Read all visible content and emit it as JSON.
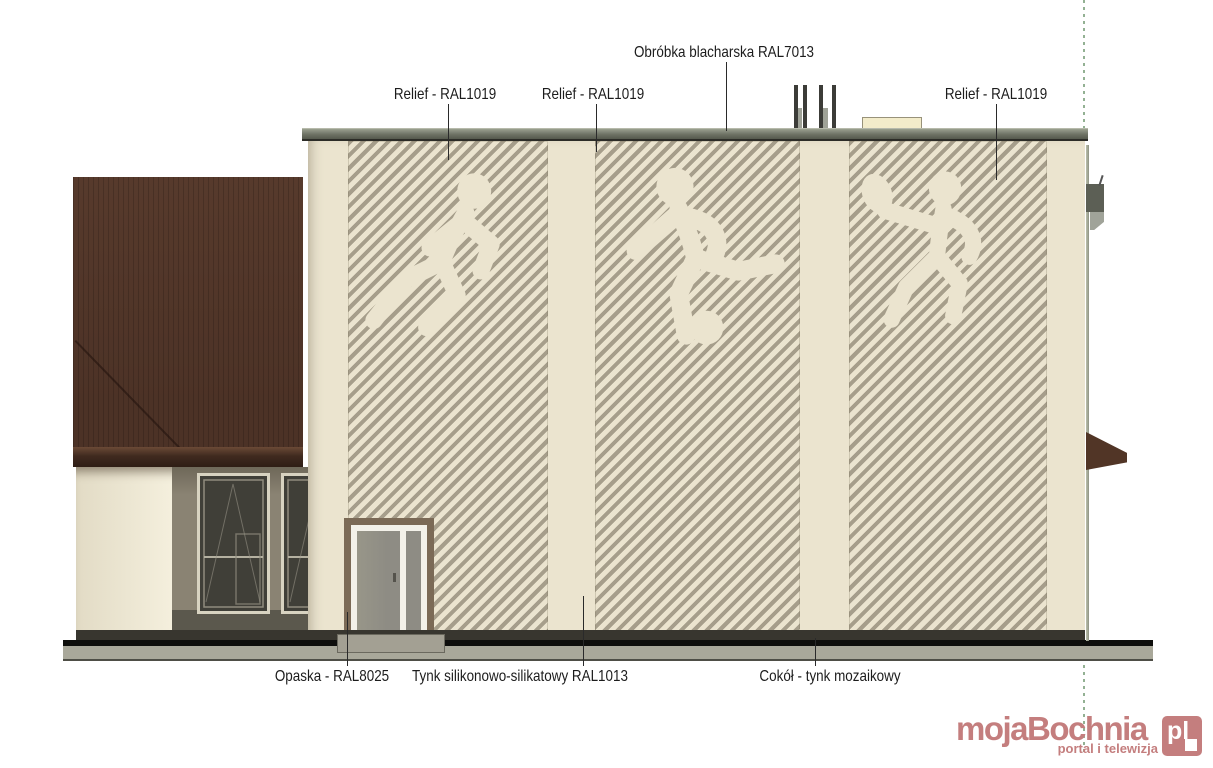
{
  "colors": {
    "wall-cream": "#ebe4cf",
    "panel-stripe": "#a69e8b",
    "cap-gray": "#6d7164",
    "roof-brown": "#573a2c",
    "fascia-brown": "#2e1d15",
    "recess-taupe": "#8a8373",
    "window-dark": "#403f38",
    "door-trim-brown": "#7b6a56",
    "door-gray": "#8e8c84",
    "plinth-dark": "#38362f",
    "terrain-gray": "#a9a89a",
    "leader-dark": "#2a2a2a",
    "boundary-green": "#93b193",
    "brand-rose": "#c47e7e"
  },
  "annotations": {
    "top_labels": [
      {
        "text": "Relief - RAL1019"
      },
      {
        "text": "Relief - RAL1019"
      },
      {
        "text": "Obróbka blacharska RAL7013"
      },
      {
        "text": "Relief - RAL1019"
      }
    ],
    "bottom_labels": [
      {
        "text": "Opaska - RAL8025"
      },
      {
        "text": "Tynk silikonowo-silikatowy RAL1013"
      },
      {
        "text": "Cokół - tynk mozaikowy"
      }
    ]
  },
  "relief_figures": [
    {
      "name": "runner"
    },
    {
      "name": "football-player"
    },
    {
      "name": "tennis-player"
    }
  ],
  "watermark": {
    "brand": "mojaBochnia",
    "tld": "pl",
    "tagline": "portal i telewizja"
  }
}
